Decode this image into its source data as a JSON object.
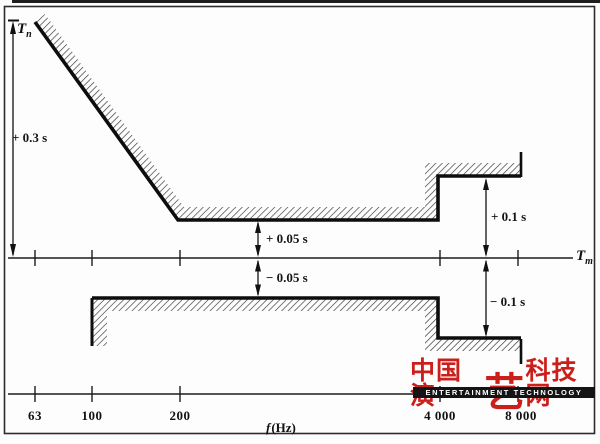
{
  "figure": {
    "y_axis": {
      "symbol": "T",
      "subscript": "n"
    },
    "mid_axis": {
      "symbol": "T",
      "subscript": "m"
    },
    "freq_axis": {
      "symbol": "f",
      "unit": "(Hz)",
      "ticks": [
        "63",
        "100",
        "200",
        "4 000",
        "8 000"
      ]
    },
    "tolerances": {
      "upper_low": "+ 0.3 s",
      "upper_mid": "+ 0.05 s",
      "lower_mid": "− 0.05 s",
      "upper_high": "+ 0.1 s",
      "lower_high": "− 0.1 s"
    }
  },
  "watermark": {
    "cn_prefix": "中国演",
    "cn_art": "艺",
    "cn_suffix": "科技网",
    "en": "ENTERTAINMENT TECHNOLOGY"
  },
  "colors": {
    "watermark_red": "#cb1f1b",
    "watermark_bar": "#141414",
    "ink": "#111111",
    "hatch": "#3a3a3a"
  },
  "chart_data": {
    "type": "area",
    "title": "Reverberation time tolerance limits (Tn relative to Tm) versus frequency",
    "xlabel": "f (Hz)",
    "ylabel": "tolerance (s)",
    "x_ticks": [
      63,
      100,
      200,
      4000,
      8000
    ],
    "x_scale": "log-schematic",
    "grid": false,
    "series": [
      {
        "name": "upper tolerance limit",
        "x": [
          63,
          200,
          4000,
          4000,
          8000
        ],
        "y_s": [
          0.3,
          0.05,
          0.05,
          0.1,
          0.1
        ],
        "hatch_side": "above"
      },
      {
        "name": "lower tolerance limit",
        "x": [
          100,
          4000,
          4000,
          8000
        ],
        "y_s": [
          -0.05,
          -0.05,
          -0.1,
          -0.1
        ],
        "hatch_side": "below"
      }
    ],
    "annotations": [
      "+ 0.3 s",
      "+ 0.05 s",
      "− 0.05 s",
      "+ 0.1 s",
      "− 0.1 s"
    ]
  }
}
